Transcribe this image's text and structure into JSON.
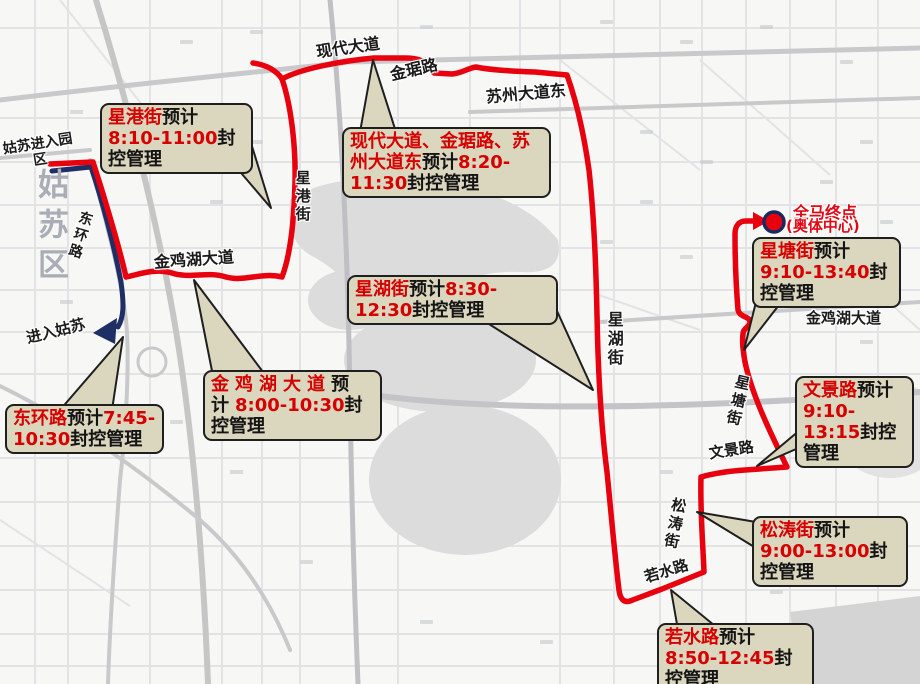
{
  "map": {
    "region_watermark": "姑苏区",
    "entry_note_line1": "姑苏进入园",
    "entry_note_line2": "区",
    "exit_note": "进入姑苏",
    "finish": {
      "line1": "全马终点",
      "line2": "(奥体中心)"
    },
    "roads": [
      {
        "text": "现代大道"
      },
      {
        "text": "金琚路"
      },
      {
        "text": "苏州大道东"
      },
      {
        "text": "星港街"
      },
      {
        "text": "金鸡湖大道"
      },
      {
        "text": "星湖街"
      },
      {
        "text": "金鸡湖大道"
      },
      {
        "text": "星塘街"
      },
      {
        "text": "文景路"
      },
      {
        "text": "松涛街"
      },
      {
        "text": "若水路"
      },
      {
        "text": "东环路"
      }
    ]
  },
  "callouts": [
    {
      "road": "星港街",
      "segments": [
        {
          "t": "星港街",
          "c": "red"
        },
        {
          "t": "预计",
          "c": "blk"
        },
        {
          "t": "8:10-11:00",
          "c": "red"
        },
        {
          "t": "封控管理",
          "c": "blk"
        }
      ]
    },
    {
      "road": "现代大道、金琚路、苏州大道东",
      "segments": [
        {
          "t": "现代大道、金琚路、苏州大道东",
          "c": "red"
        },
        {
          "t": "预计",
          "c": "blk"
        },
        {
          "t": "8:20-11:30",
          "c": "red"
        },
        {
          "t": "封控管理",
          "c": "blk"
        }
      ]
    },
    {
      "road": "星湖街",
      "segments": [
        {
          "t": "星湖街",
          "c": "red"
        },
        {
          "t": "预计",
          "c": "blk"
        },
        {
          "t": "8:30-12:30",
          "c": "red"
        },
        {
          "t": "封控管理",
          "c": "blk"
        }
      ]
    },
    {
      "road": "金鸡湖大道",
      "segments": [
        {
          "t": "金鸡湖大道",
          "c": "red"
        },
        {
          "t": "预计",
          "c": "blk"
        },
        {
          "t": "8:00-10:30",
          "c": "red"
        },
        {
          "t": "封控管理",
          "c": "blk"
        }
      ]
    },
    {
      "road": "星塘街",
      "segments": [
        {
          "t": "星塘街",
          "c": "red"
        },
        {
          "t": "预计",
          "c": "blk"
        },
        {
          "t": "9:10-13:40",
          "c": "red"
        },
        {
          "t": "封控管理",
          "c": "blk"
        }
      ]
    },
    {
      "road": "文景路",
      "segments": [
        {
          "t": "文景路",
          "c": "red"
        },
        {
          "t": "预计",
          "c": "blk"
        },
        {
          "t": "9:10-13:15",
          "c": "red"
        },
        {
          "t": "封控管理",
          "c": "blk"
        }
      ]
    },
    {
      "road": "松涛街",
      "segments": [
        {
          "t": "松涛街",
          "c": "red"
        },
        {
          "t": "预计",
          "c": "blk"
        },
        {
          "t": "9:00-13:00",
          "c": "red"
        },
        {
          "t": "封控管理",
          "c": "blk"
        }
      ]
    },
    {
      "road": "若水路",
      "segments": [
        {
          "t": "若水路",
          "c": "red"
        },
        {
          "t": "预计",
          "c": "blk"
        },
        {
          "t": "8:50-12:45",
          "c": "red"
        },
        {
          "t": "封控管理",
          "c": "blk"
        }
      ]
    },
    {
      "road": "东环路",
      "segments": [
        {
          "t": "东环路",
          "c": "red"
        },
        {
          "t": "预计",
          "c": "blk"
        },
        {
          "t": "7:45-10:30",
          "c": "red"
        },
        {
          "t": "封控管理",
          "c": "blk"
        }
      ]
    }
  ],
  "colors": {
    "route_red": "#e8000f",
    "detour_blue": "#1f2f66",
    "callout_bg": "#dbd6be",
    "callout_red_text": "#d60000",
    "finish_dot_fill": "#e8000f",
    "finish_dot_ring": "#1b2a5e"
  }
}
